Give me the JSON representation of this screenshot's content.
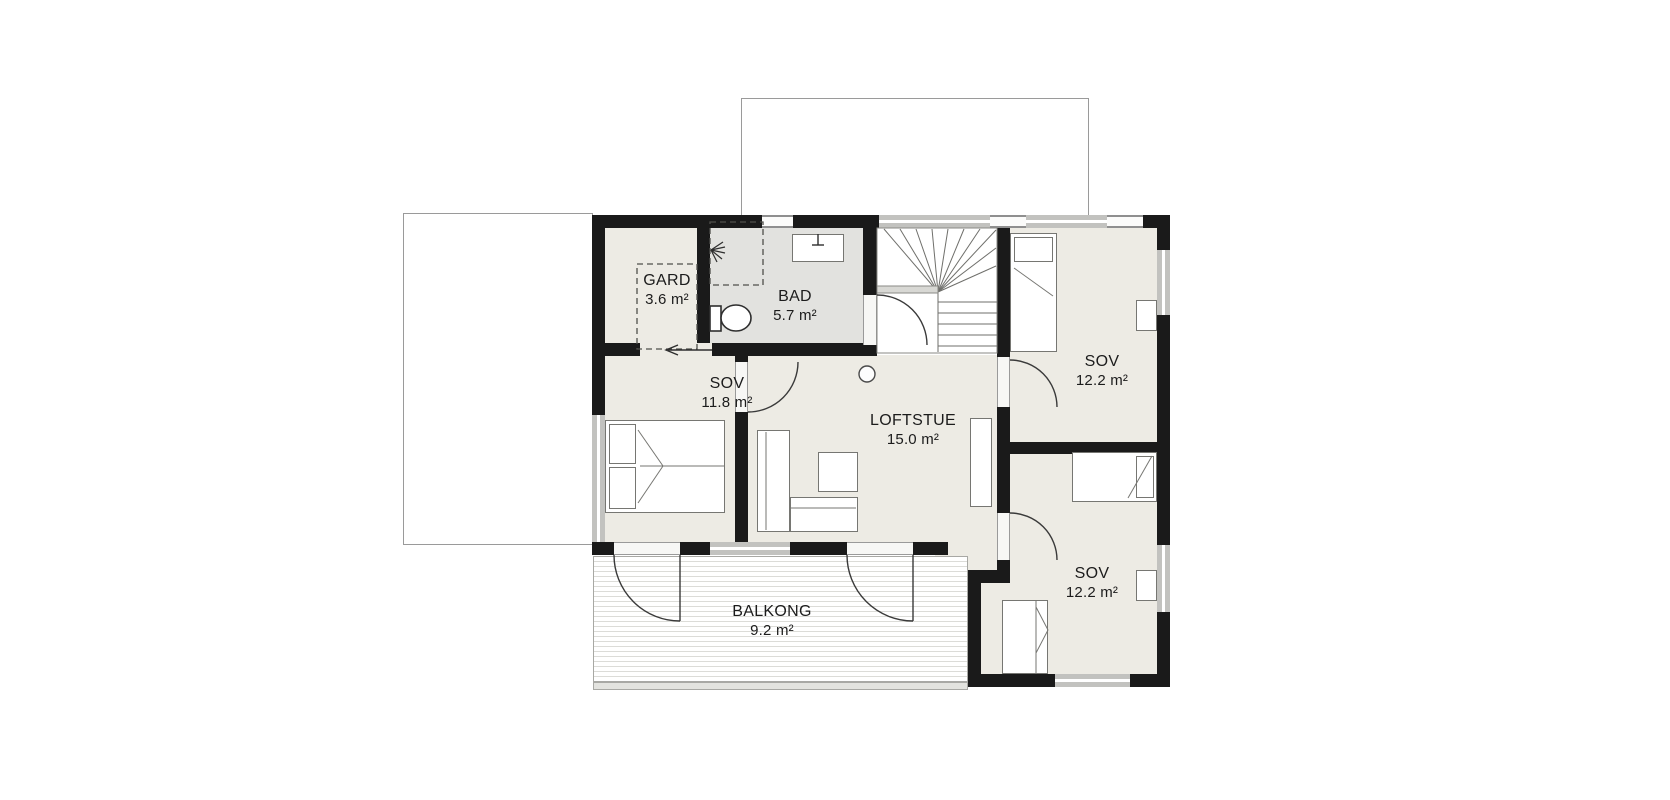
{
  "floorplan": {
    "rooms": [
      {
        "name": "GARD",
        "area": "3.6 m²"
      },
      {
        "name": "BAD",
        "area": "5.7 m²"
      },
      {
        "name": "SOV",
        "area": "11.8 m²"
      },
      {
        "name": "LOFTSTUE",
        "area": "15.0 m²"
      },
      {
        "name": "SOV",
        "area": "12.2 m²"
      },
      {
        "name": "SOV",
        "area": "12.2 m²"
      },
      {
        "name": "BALKONG",
        "area": "9.2 m²"
      }
    ],
    "colors": {
      "wall": "#1a1a1a",
      "floor": "#edebe4",
      "bath_floor": "#e2e2df",
      "deck_stripe": "#dcdcd8",
      "outline": "#9a9a9a"
    }
  }
}
